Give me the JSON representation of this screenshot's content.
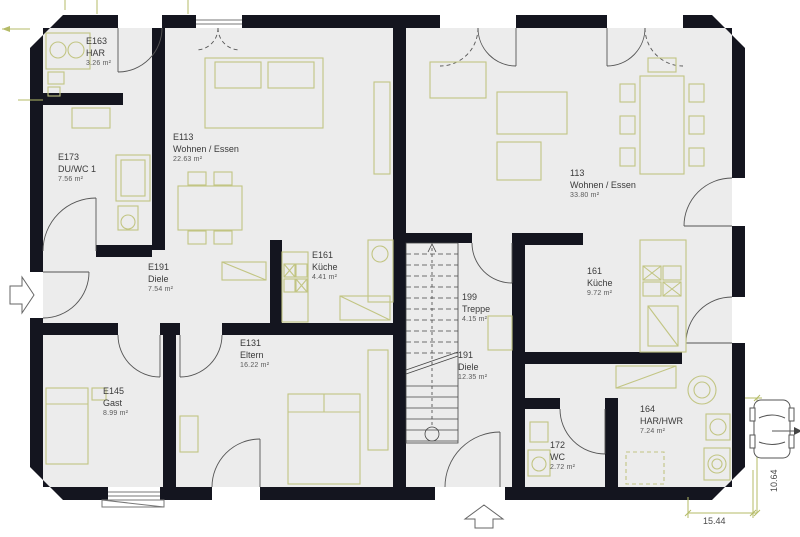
{
  "plan": {
    "type": "floorplan-ground-floor",
    "rooms": [
      {
        "id": "E163",
        "name": "HAR",
        "area": "3.26 m²"
      },
      {
        "id": "E173",
        "name": "DU/WC 1",
        "area": "7.56 m²"
      },
      {
        "id": "E113",
        "name": "Wohnen / Essen",
        "area": "22.63 m²"
      },
      {
        "id": "E161",
        "name": "Küche",
        "area": "4.41 m²"
      },
      {
        "id": "E191",
        "name": "Diele",
        "area": "7.54 m²"
      },
      {
        "id": "E145",
        "name": "Gast",
        "area": "8.99 m²"
      },
      {
        "id": "E131",
        "name": "Eltern",
        "area": "16.22 m²"
      },
      {
        "id": "199",
        "name": "Treppe",
        "area": "4.15 m²"
      },
      {
        "id": "191",
        "name": "Diele",
        "area": "12.35 m²"
      },
      {
        "id": "113",
        "name": "Wohnen / Essen",
        "area": "33.80 m²"
      },
      {
        "id": "161",
        "name": "Küche",
        "area": "9.72 m²"
      },
      {
        "id": "164",
        "name": "HAR/HWR",
        "area": "7.24 m²"
      },
      {
        "id": "172",
        "name": "WC",
        "area": "2.72 m²"
      }
    ],
    "dimensions": {
      "width_label": "15.44",
      "height_label": "10.64"
    },
    "icons": [
      "entrance-arrow-left",
      "entrance-arrow-bottom",
      "car-icon",
      "staircase"
    ],
    "colors": {
      "wall": "#14151f",
      "floor": "#ececec",
      "furniture": "#c2c583",
      "door": "#555555",
      "dimension": "#b5bb67",
      "text": "#3a3a3a"
    }
  }
}
